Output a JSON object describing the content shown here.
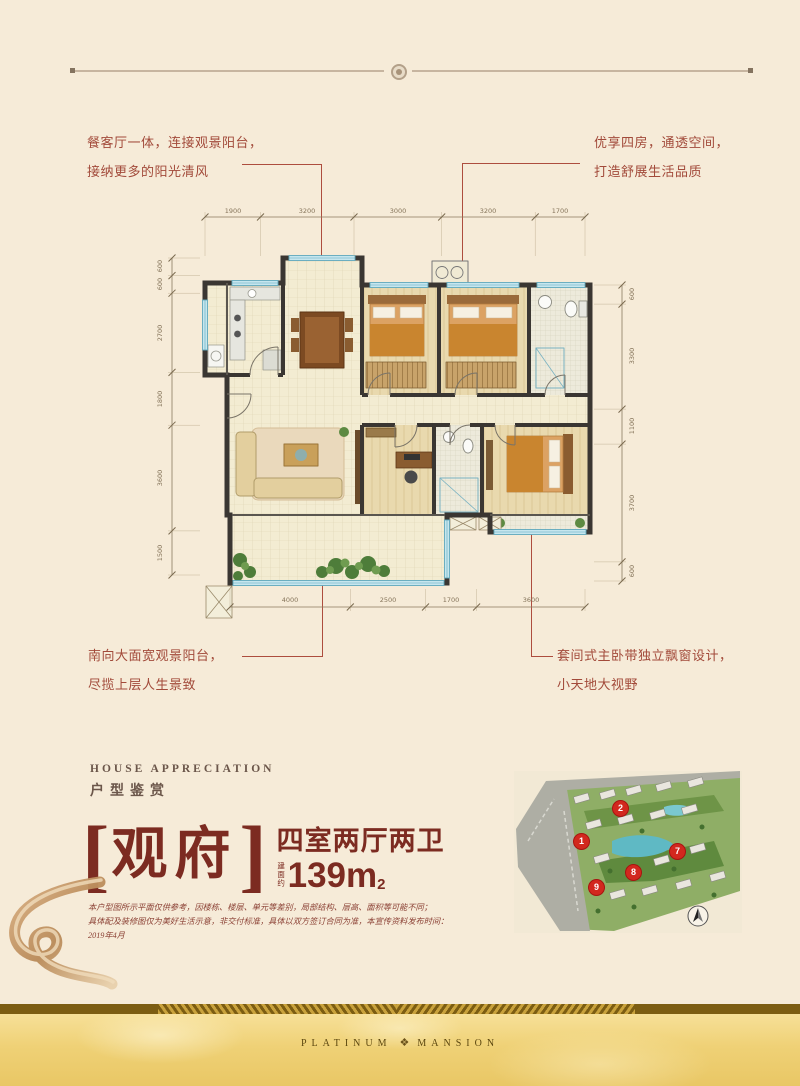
{
  "page": {
    "bg_color": "#f6ebd8",
    "accent_red": "#ad4d3e",
    "title_maroon": "#7c2b21",
    "gold": "#eecb6d"
  },
  "callouts": {
    "top_left": {
      "line1": "餐客厅一体，连接观景阳台，",
      "line2": "接纳更多的阳光清风"
    },
    "top_right": {
      "line1": "优享四房，通透空间，",
      "line2": "打造舒展生活品质"
    },
    "bottom_left": {
      "line1": "南向大面宽观景阳台，",
      "line2": "尽揽上层人生景致"
    },
    "bottom_right": {
      "line1": "套间式主卧带独立飘窗设计，",
      "line2": "小天地大视野"
    }
  },
  "floorplan": {
    "dims_top": [
      "1900",
      "3200",
      "3000",
      "3200",
      "1700"
    ],
    "dims_left": [
      "600",
      "600",
      "2700",
      "1800",
      "3600",
      "1500"
    ],
    "dims_right": [
      "600",
      "3300",
      "1100",
      "3700",
      "600"
    ],
    "dims_bottom": [
      "4000",
      "2500",
      "1700",
      "3600"
    ]
  },
  "section": {
    "eyebrow_en": "HOUSE APPRECIATION",
    "eyebrow_cn": "户型鉴赏"
  },
  "unit": {
    "bracket_open": "[",
    "name": "观府",
    "bracket_close": "]",
    "layout": "四室两厅两卫",
    "area_prefix": "建面约",
    "area_value": "139m",
    "area_exp": "2"
  },
  "disclaimer": {
    "line1": "本户型图所示平面仅供参考，因楼栋、楼层、单元等差别，局部结构、层高、面积等可能不同；",
    "line2": "具体配及装修图仅为美好生活示意，非交付标准，具体以双方签订合同为准，本宣传资料发布时间：2019年4月"
  },
  "sitemap": {
    "markers": [
      "1",
      "2",
      "7",
      "8",
      "9"
    ]
  },
  "footer": {
    "brand_left": "PLATINUM",
    "brand_right": "MANSION"
  }
}
